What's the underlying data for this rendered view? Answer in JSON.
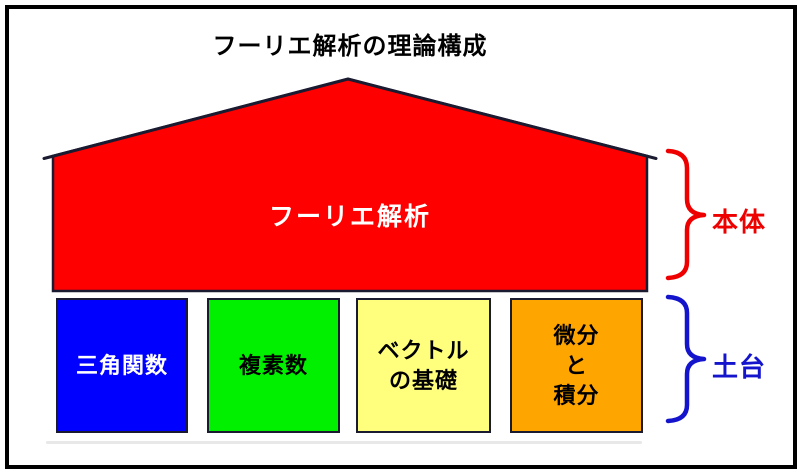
{
  "title": "フーリエ解析の理論構成",
  "house": {
    "label": "フーリエ解析",
    "fill": "#ff0000",
    "outline": "#1a1a30"
  },
  "boxes": [
    {
      "lines": [
        "三角関数"
      ],
      "fill": "#0000ff",
      "text_color": "#ffffff"
    },
    {
      "lines": [
        "複素数"
      ],
      "fill": "#00f000",
      "text_color": "#000000"
    },
    {
      "lines": [
        "ベクトル",
        "の基礎"
      ],
      "fill": "#ffff7d",
      "text_color": "#000000"
    },
    {
      "lines": [
        "微分",
        "と",
        "積分"
      ],
      "fill": "#ffa500",
      "text_color": "#000000"
    }
  ],
  "braces": {
    "body": {
      "label": "本体",
      "color": "#ee0000"
    },
    "foundation": {
      "label": "土台",
      "color": "#1414cc"
    }
  },
  "colors": {
    "frame": "#000000",
    "background": "#ffffff",
    "shadow": "#e8e8e8"
  }
}
